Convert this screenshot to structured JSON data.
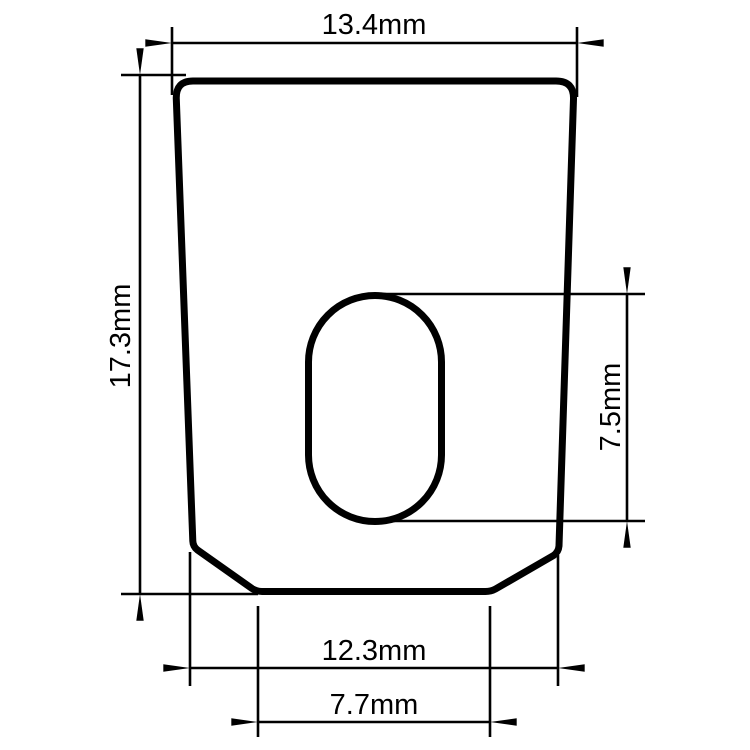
{
  "colors": {
    "background": "#ffffff",
    "line": "#000000"
  },
  "drawing": {
    "type": "technical-drawing",
    "units": "mm",
    "part_description": "tapered plate, rounded top corners, chamfered bottom corners, vertical stadium slot",
    "dimensions": {
      "top_width": {
        "label": "13.4mm",
        "value": 13.4,
        "unit": "mm",
        "measures": "overall top width"
      },
      "overall_height": {
        "label": "17.3mm",
        "value": 17.3,
        "unit": "mm",
        "measures": "overall height, left side"
      },
      "slot_height": {
        "label": "7.5mm",
        "value": 7.5,
        "unit": "mm",
        "measures": "slot height, right side"
      },
      "bottom_width": {
        "label": "12.3mm",
        "value": 12.3,
        "unit": "mm",
        "measures": "width at bottom chamfer corners"
      },
      "bottom_flat": {
        "label": "7.7mm",
        "value": 7.7,
        "unit": "mm",
        "measures": "bottom flat edge width"
      }
    }
  }
}
